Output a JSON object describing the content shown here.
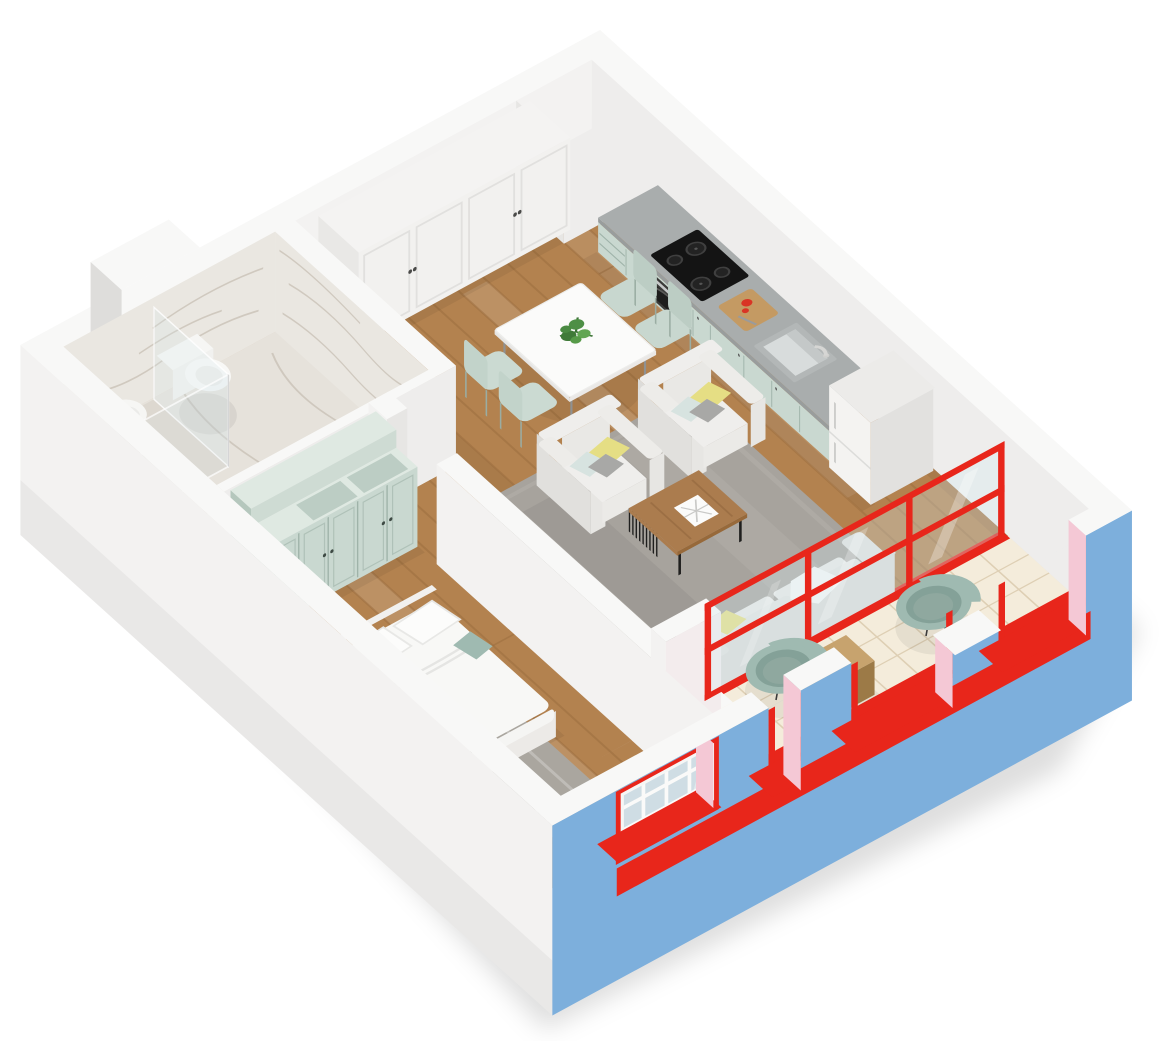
{
  "canvas": {
    "width": 1170,
    "height": 1041,
    "background": "#ffffff"
  },
  "scene": {
    "type": "isometric-3d-floorplan-render",
    "description": "One-bedroom apartment 3D floor plan, white walls, wood floors, blue exterior balcony facade with red window frames",
    "rooms": [
      {
        "id": "kitchen-living-dining",
        "floor": "wood",
        "furniture": [
          "kitchen counter with black cooktop and oven",
          "kitchen sink with faucet",
          "refrigerator",
          "cutting board with tomato",
          "white dining table",
          "potted green plant",
          "4 mint dining chairs",
          "2 light armchairs with yellow, blue and gray pillows",
          "wood coffee table with black slat base and white book",
          "light gray sofa with yellow pillow and white blanket",
          "gray area rug"
        ]
      },
      {
        "id": "bedroom",
        "floor": "wood",
        "furniture": [
          "double bed with white duvet and two pillows",
          "teal folded blanket",
          "mint wardrobe with top cubbies",
          "gray area rug"
        ]
      },
      {
        "id": "bathroom",
        "floor": "marble",
        "furniture": [
          "wall-hung toilet",
          "bidet",
          "glass shower partition with chrome pole"
        ]
      },
      {
        "id": "hallway",
        "floor": "wood",
        "furniture": [
          "white built-in wardrobe with panel doors"
        ]
      },
      {
        "id": "balcony",
        "floor": "cream-tile",
        "furniture": [
          "2 teal bowl chairs on metal legs",
          "wooden box"
        ]
      },
      {
        "id": "vent-shaft-north",
        "floor": "gray"
      },
      {
        "id": "vent-shaft-west",
        "floor": "none"
      }
    ],
    "facade": {
      "wall_color_key": "blue",
      "accent_color_key": "red",
      "reveal_color_key": "pink",
      "elements": [
        "red framed glazing between living room and balcony",
        "parapet openings with red railings and sills",
        "bedroom window with red frame and white muntins",
        "continuous red slab band"
      ]
    }
  },
  "colors": {
    "bg": "#ffffff",
    "wallTop": "#f8f8f7",
    "wallBright": "#f3f2f1",
    "wallLight": "#eeedec",
    "wallMid": "#e7e6e4",
    "wallShade": "#dedddb",
    "wallDark": "#d2d1cf",
    "floorWood": "#b3824f",
    "woodLine": "#9a6c3e",
    "woodLight": "#c59a6a",
    "marble": "#eae7e1",
    "marbleFloor": "#e6e2db",
    "marbleVein": "#c9c2b6",
    "showerFloor": "#ddd8d0",
    "tile": "#f4ecdb",
    "tileLine": "#decfb4",
    "red": "#e8261b",
    "redDark": "#c01910",
    "blue": "#7dafdc",
    "pink": "#f4c8d5",
    "mintFront": "#c9d8d0",
    "mintSide": "#b5c7bd",
    "mintTop": "#dfe9e2",
    "mintDark": "#9fb3a9",
    "counter": "#a9adad",
    "counterEdge": "#999d9d",
    "black": "#161616",
    "steel": "#c6c8c8",
    "fridge": "#f4f3f1",
    "fridgeSide": "#e2e1df",
    "white": "#fbfbfa",
    "softWhite": "#efeeec",
    "rug": "#a7a39d",
    "rugBed": "#aaa69f",
    "sofa": "#e2e1de",
    "sofaShade": "#d6d5d2",
    "seat": "#e9e8e5",
    "woodTable": "#ab7c4e",
    "woodTableEdge": "#8f6238",
    "yellow": "#e5de84",
    "pillowBlue": "#d7e3e0",
    "pillowGray": "#a8a8a6",
    "plant": "#4e8f46",
    "plantDark": "#3c7336",
    "teal": "#9fbab1",
    "tealDark": "#84a198",
    "tealSeat": "#8fa89f",
    "wood2": "#c7a36e",
    "wood2Side": "#ad8a55",
    "grayFloor": "#d8d8d8",
    "chrome": "#6b6b6b"
  }
}
